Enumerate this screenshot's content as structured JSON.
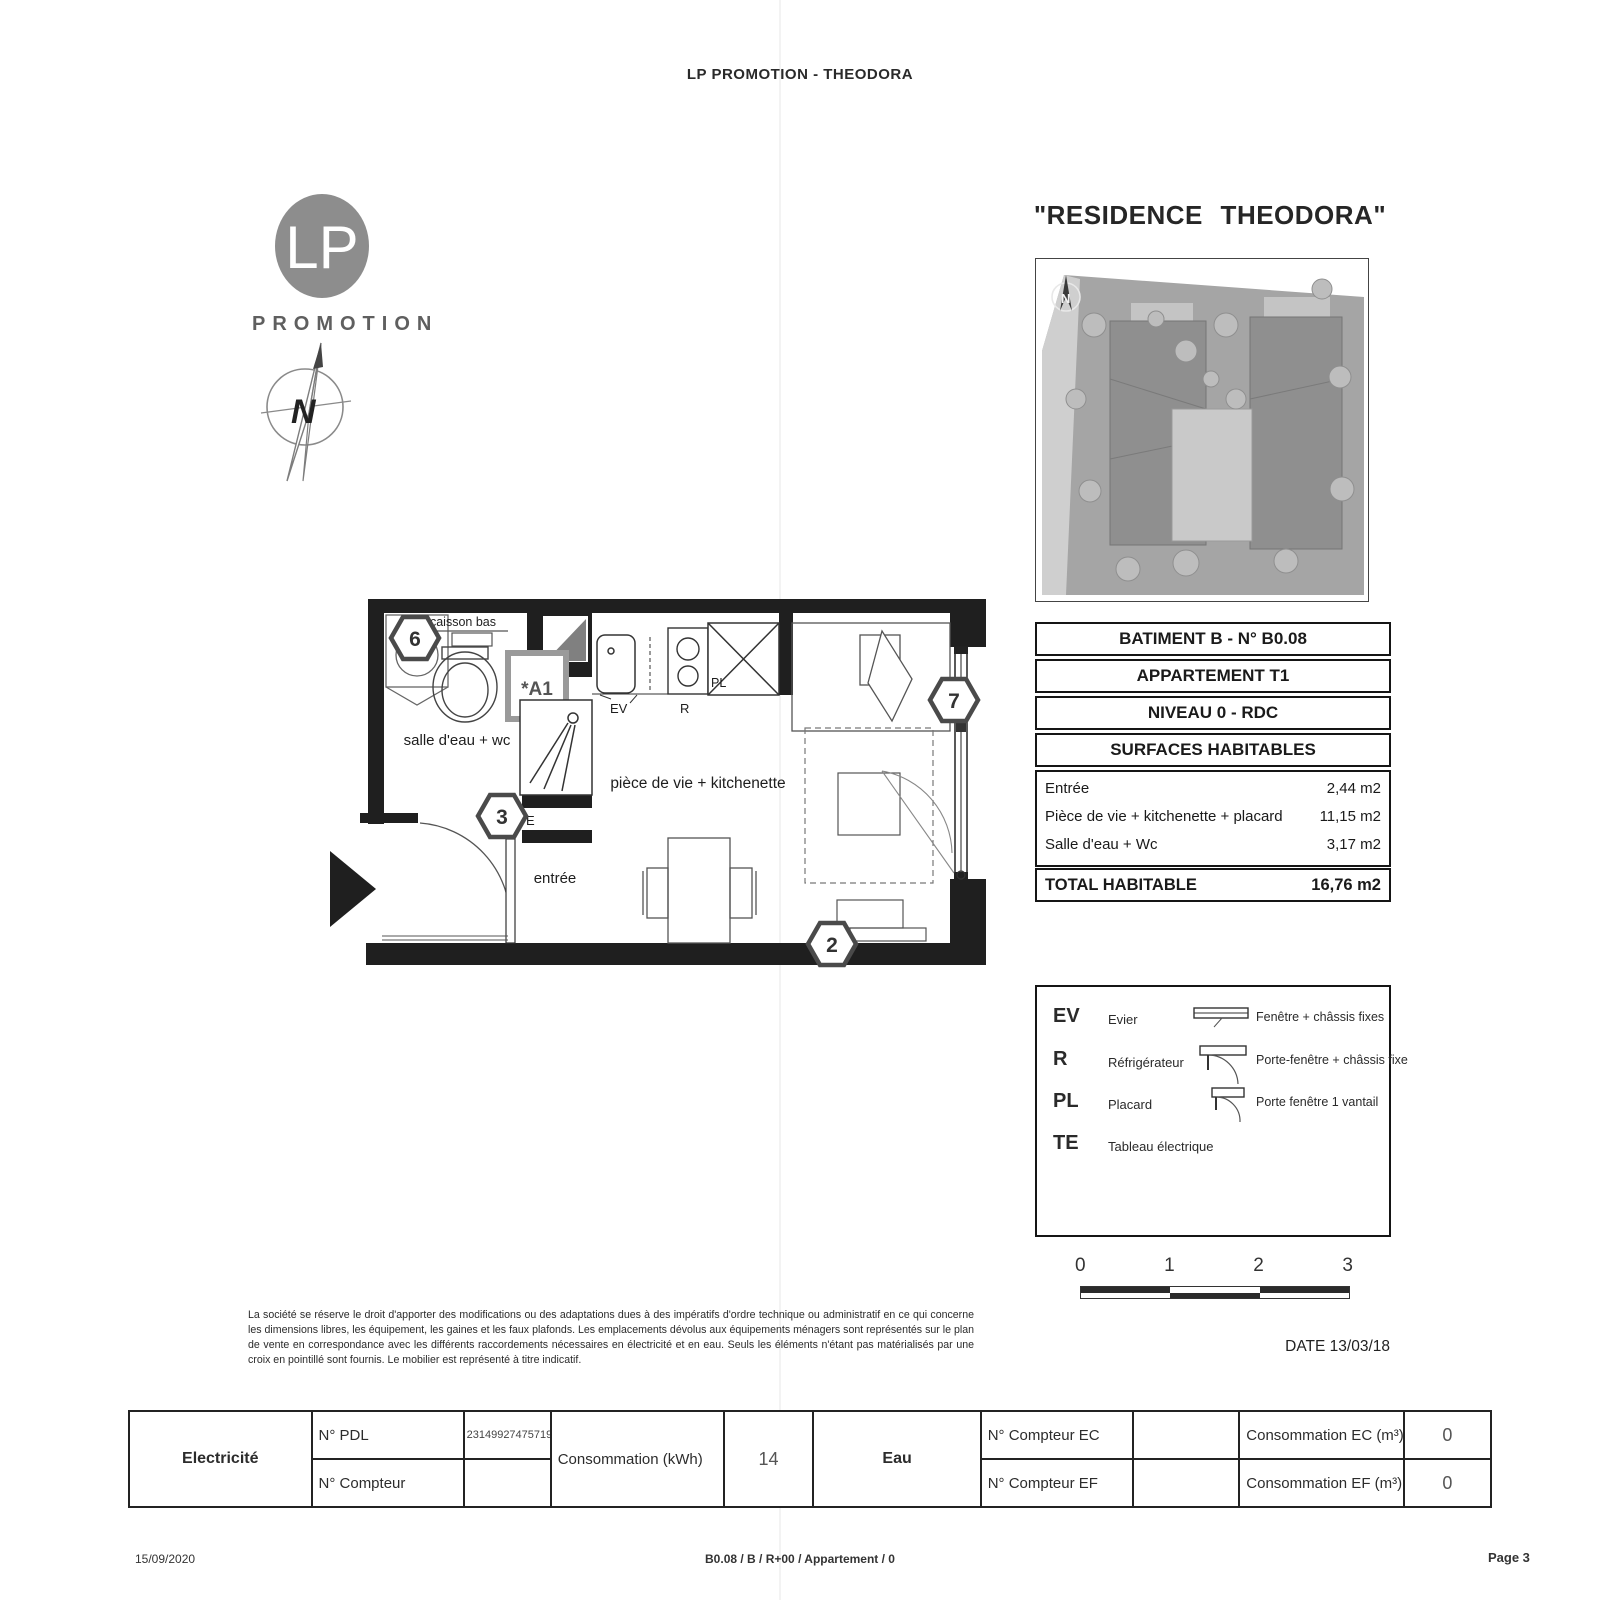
{
  "page": {
    "header": "LP PROMOTION - THEODORA",
    "title": "\"RESIDENCE THEODORA\"",
    "plan_date": "DATE 13/03/18"
  },
  "logo": {
    "initials": "LP",
    "name": "PROMOTION"
  },
  "compass": {
    "letter": "N"
  },
  "site_plan": {
    "compass_letter": "N"
  },
  "floor_plan": {
    "markers": {
      "m6": "6",
      "m3": "3",
      "m2": "2",
      "m7": "7"
    },
    "badge": "*A1",
    "labels": {
      "caisson_bas": "caisson bas",
      "salle_deau": "salle d'eau + wc",
      "entree": "entrée",
      "piece_vie": "pièce de vie + kitchenette",
      "ev": "EV",
      "r": "R",
      "pl": "PL",
      "e": "E"
    }
  },
  "info_table": {
    "rows": [
      "BATIMENT B - N° B0.08",
      "APPARTEMENT T1",
      "NIVEAU 0 - RDC",
      "SURFACES HABITABLES"
    ],
    "surfaces": [
      {
        "label": "Entrée",
        "value": "2,44 m2"
      },
      {
        "label": "Pièce de vie + kitchenette + placard",
        "value": "11,15 m2"
      },
      {
        "label": "Salle d'eau + Wc",
        "value": "3,17 m2"
      }
    ],
    "total": {
      "label": "TOTAL HABITABLE",
      "value": "16,76 m2"
    }
  },
  "legend": {
    "codes": [
      {
        "code": "EV",
        "label": "Evier"
      },
      {
        "code": "R",
        "label": "Réfrigérateur"
      },
      {
        "code": "PL",
        "label": "Placard"
      },
      {
        "code": "TE",
        "label": "Tableau électrique"
      }
    ],
    "symbols": [
      {
        "label": "Fenêtre + châssis fixes"
      },
      {
        "label": "Porte-fenêtre + châssis fixe"
      },
      {
        "label": "Porte fenêtre 1 vantail"
      }
    ]
  },
  "scale_bar": {
    "ticks": [
      "0",
      "1",
      "2",
      "3"
    ]
  },
  "disclaimer": "La société se réserve le droit d'apporter des modifications ou des adaptations dues à des impératifs d'ordre technique ou administratif en ce qui concerne les dimensions libres, les équipement, les gaines et les faux plafonds. Les emplacements dévolus aux équipements ménagers sont représentés sur le plan de vente en correspondance avec les différents raccordements nécessaires en électricité et en eau. Seuls les éléments n'étant pas matérialisés par une croix en pointillé sont fournis. Le mobilier est représenté à titre indicatif.",
  "meters": {
    "electricite": {
      "label": "Electricité",
      "pdl_label": "N° PDL",
      "pdl_value": "23149927475719",
      "compteur_label": "N° Compteur",
      "compteur_value": "",
      "conso_label": "Consommation (kWh)",
      "conso_value": "14"
    },
    "eau": {
      "label": "Eau",
      "ec_label": "N° Compteur EC",
      "ec_value": "",
      "ef_label": "N° Compteur EF",
      "ef_value": "",
      "conso_ec_label": "Consommation EC (m³)",
      "conso_ec_value": "0",
      "conso_ef_label": "Consommation EF (m³)",
      "conso_ef_value": "0"
    }
  },
  "footer": {
    "date": "15/09/2020",
    "center": "B0.08 / B / R+00 / Appartement / 0",
    "page": "Page 3"
  }
}
